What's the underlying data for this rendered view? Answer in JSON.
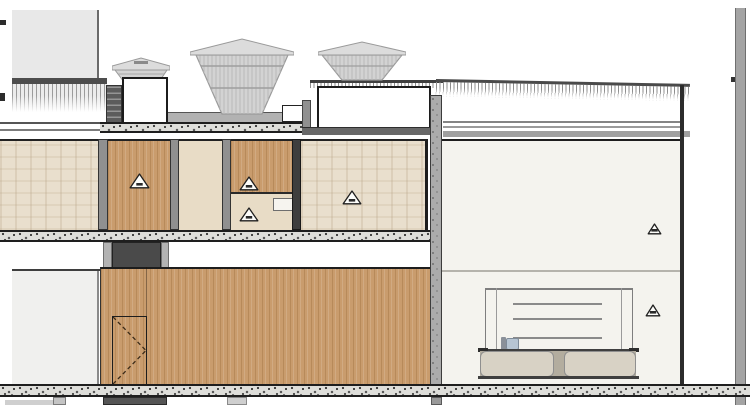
{
  "drawing": {
    "kind": "architectural-building-section",
    "visible_text": ""
  },
  "colors": {
    "massGray": "#e8e8e8",
    "bandDark": "#4d4d4d",
    "louver": "#5c5c5c",
    "cowlFill": "#d3d3d3",
    "cowlCap": "#dcdcdc",
    "cowlStroke": "#9a9a9a",
    "deck": "#b2b2b2",
    "slabBase": "#dededa",
    "lineDark": "#1f1f1f",
    "mullion": "#909090",
    "wallDark": "#3e3e3e",
    "wood": "#c99c6d",
    "woodDark": "#76481a",
    "beige": "#e9dfcd",
    "roomLight": "#e8dcc6",
    "offWhite": "#f4f3ee",
    "leftWall": "#f0f0ee",
    "ceilDark": "#686868",
    "ceilLight": "#a0a0a0",
    "cabinet": "#d8d2c5",
    "cabinetGap": "#b3ad9f",
    "glass": "#b7c5d3",
    "rightCol": "#a4a4a4"
  },
  "markers": {
    "warning_triangles": [
      {
        "x": 139,
        "y": 181,
        "w": 21,
        "h": 16
      },
      {
        "x": 249,
        "y": 183,
        "w": 20,
        "h": 15
      },
      {
        "x": 249,
        "y": 214,
        "w": 20,
        "h": 15
      },
      {
        "x": 352,
        "y": 197,
        "w": 20,
        "h": 15
      },
      {
        "x": 654,
        "y": 229,
        "w": 15,
        "h": 12
      },
      {
        "x": 653,
        "y": 310,
        "w": 16,
        "h": 13
      }
    ]
  }
}
